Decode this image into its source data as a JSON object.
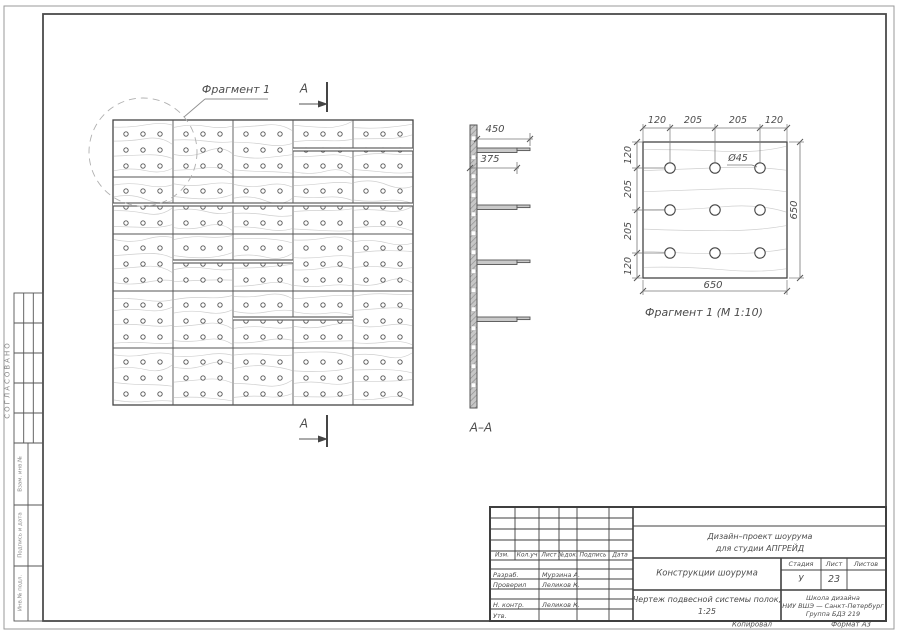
{
  "colors": {
    "ink": "#4c4c4c",
    "frame": "#4a4a4a",
    "grain": "#cfcfcf",
    "dash": "#b0b0b0",
    "fill": "#d8d8d8"
  },
  "drawing": {
    "fragment_callout": "Фрагмент 1",
    "section_letter_top": "А",
    "section_letter_bottom": "А",
    "section_view_label": "А–А",
    "fragment_caption": "Фрагмент 1 (М 1:10)",
    "dims": {
      "shelf_length": "450",
      "shelf_depth": "375",
      "top_chain": [
        "120",
        "205",
        "205",
        "120"
      ],
      "left_chain": [
        "120",
        "205",
        "205",
        "120"
      ],
      "panel_width": "650",
      "panel_height": "650",
      "hole_diameter": "Ø45"
    }
  },
  "geometry": {
    "wall": {
      "x": 113,
      "y": 120,
      "w": 300,
      "h": 285,
      "cols": 5,
      "rows": 5,
      "hole_cols": 3,
      "hole_rows": 3,
      "hole_r": 2.2,
      "shelves": [
        {
          "y": 148,
          "x1": 293,
          "x2": 413
        },
        {
          "y": 203,
          "x1": 113,
          "x2": 413
        },
        {
          "y": 260,
          "x1": 173,
          "x2": 293
        },
        {
          "y": 317,
          "x1": 233,
          "x2": 353
        }
      ],
      "callout_circle": {
        "cx": 143,
        "cy": 152,
        "r": 54
      }
    },
    "section": {
      "x": 470,
      "y": 125,
      "w": 7,
      "h": 283,
      "shelves_y": [
        148,
        205,
        260,
        317
      ],
      "shelf_len": 40,
      "tip_len": 13,
      "hole_step": 19
    },
    "fragment": {
      "x": 643,
      "y": 142,
      "w": 144,
      "h": 136,
      "hole_x": [
        670,
        715,
        760
      ],
      "hole_y": [
        168,
        210,
        253
      ],
      "hole_r": 5.2
    }
  },
  "left_margin": {
    "approved_stamp": "СОГЛАСОВАНО",
    "labels": [
      "Взам. инв.№",
      "Подпись и дата",
      "Инв.№ подл."
    ]
  },
  "title_block": {
    "header_cols": [
      "Изм.",
      "Кол.уч",
      "Лист",
      "№док.",
      "Подпись",
      "Дата"
    ],
    "rows": [
      {
        "role": "Разраб.",
        "name": "Мурзина А."
      },
      {
        "role": "Проверил",
        "name": "Леликов К."
      },
      {
        "role": "Н. контр.",
        "name": "Леликов К."
      },
      {
        "role": "Утв.",
        "name": ""
      }
    ],
    "project_line1": "Дизайн–проект шоурума",
    "project_line2": "для студии АПГРЕЙД",
    "doc_title": "Конструкции шоурума",
    "sheet_title_line1": "Чертеж подвесной системы полок,",
    "sheet_title_line2": "1:25",
    "stage_label": "Стадия",
    "sheet_label": "Лист",
    "sheets_label": "Листов",
    "stage_value": "У",
    "sheet_value": "23",
    "sheets_value": "",
    "org_line1": "Школа дизайна",
    "org_line2": "НИУ ВШЭ — Санкт-Петербург",
    "org_line3": "Группа БДЗ 219"
  },
  "footer": {
    "copied_by": "Копировал",
    "format": "Формат А3"
  }
}
